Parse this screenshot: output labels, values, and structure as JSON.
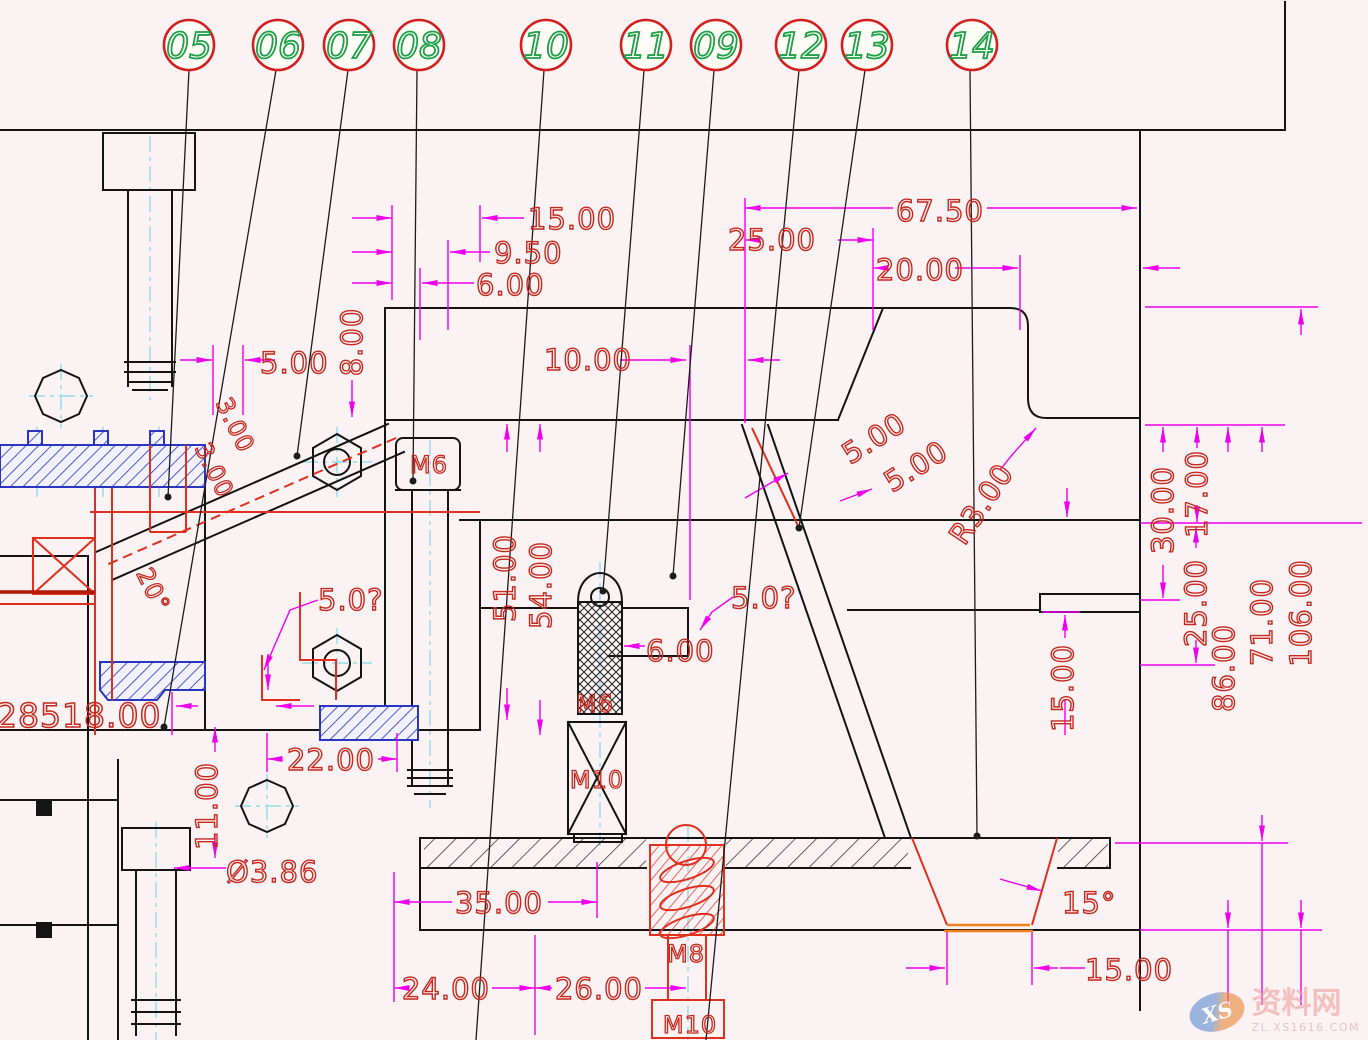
{
  "balloons": [
    {
      "label": "05"
    },
    {
      "label": "06"
    },
    {
      "label": "07"
    },
    {
      "label": "08"
    },
    {
      "label": "10"
    },
    {
      "label": "11"
    },
    {
      "label": "09"
    },
    {
      "label": "12"
    },
    {
      "label": "13"
    },
    {
      "label": "14"
    }
  ],
  "dims": {
    "top_15": "15.00",
    "top_9_5": "9.50",
    "top_6": "6.00",
    "left_5": "5.00",
    "left_8": "8.00",
    "left_3a": "3.00",
    "left_3b": "3.00",
    "angle_20": "20°",
    "top_67_5": "67.50",
    "top_25": "25.00",
    "top_20": "20.00",
    "mid_10": "10.00",
    "slant_5a": "5.00",
    "slant_5b": "5.00",
    "radius_r3": "R3.00",
    "right_30": "30.00",
    "right_17": "17.00",
    "right_25": "25.00",
    "right_86": "86.00",
    "right_71": "71.00",
    "right_106": "106.00",
    "right_15": "15.00",
    "v51": "51.00",
    "v54": "54.00",
    "mid_6": "6.00",
    "q5_left": "5.0?",
    "q5_right": "5.0?",
    "w22": "22.00",
    "v11": "11.00",
    "dia_3_86": "Ø3.86",
    "w35": "35.00",
    "w24": "24.00",
    "w26": "26.00",
    "br_15": "15.00",
    "angle_15": "15°",
    "big_left": "28518.00"
  },
  "labels": {
    "m6_head": "M6",
    "m6_pin": "M6",
    "m10_block": "M10",
    "m8_screw": "M8",
    "m10_screw": "M10"
  },
  "watermark": {
    "logo": "XS",
    "name": "资料网",
    "url": "ZL.XS1616.COM"
  }
}
